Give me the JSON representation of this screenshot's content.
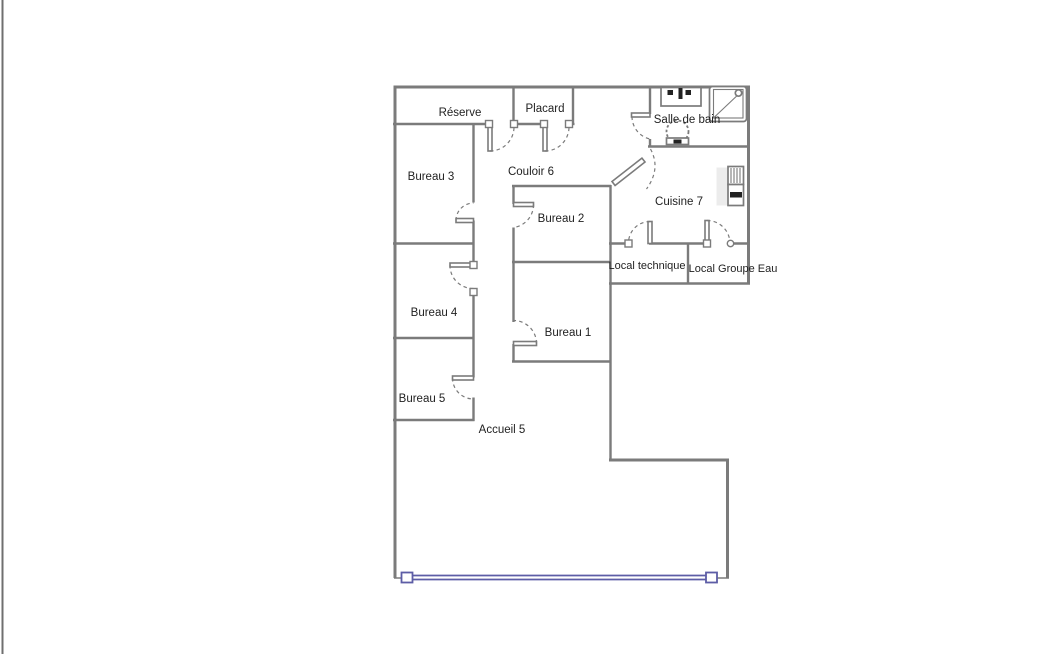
{
  "floorplan": {
    "colors": {
      "wall": "#7b7b7b",
      "window": "#5d5da6",
      "text": "#1f1f1f",
      "background": "#ffffff"
    },
    "rooms": [
      {
        "label": "Réserve"
      },
      {
        "label": "Placard"
      },
      {
        "label": "Salle de bain"
      },
      {
        "label": "Couloir 6"
      },
      {
        "label": "Bureau 3"
      },
      {
        "label": "Cuisine 7"
      },
      {
        "label": "Bureau 2"
      },
      {
        "label": "Local technique"
      },
      {
        "label": "Local Groupe Eau"
      },
      {
        "label": "Bureau 4"
      },
      {
        "label": "Bureau 1"
      },
      {
        "label": "Bureau 5"
      },
      {
        "label": "Accueil 5"
      }
    ],
    "fixtures": [
      {
        "name": "sink-icon"
      },
      {
        "name": "shower-icon"
      },
      {
        "name": "toilet-icon"
      },
      {
        "name": "water-heater-icon"
      },
      {
        "name": "window-wall"
      }
    ],
    "door_count": 11
  }
}
